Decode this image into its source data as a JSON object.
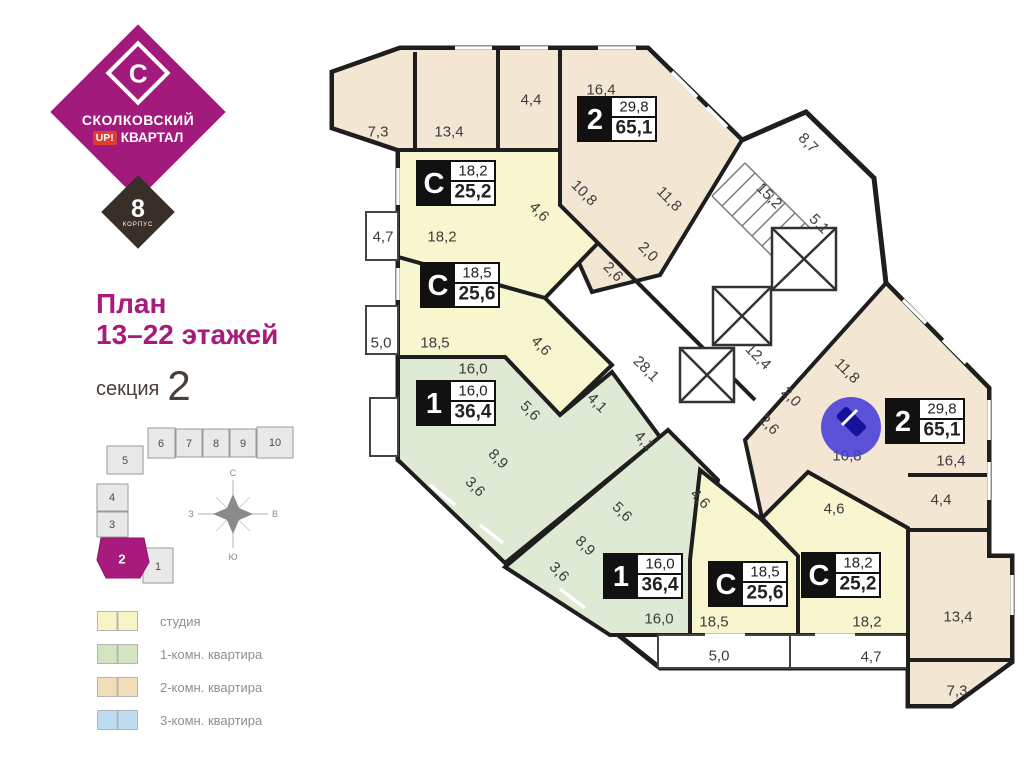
{
  "sidebar": {
    "logo": {
      "letter": "С",
      "brand_top": "СКОЛКОВСКИЙ",
      "up": "UP!",
      "brand_bottom": "КВАРТАЛ",
      "korpus_number": "8",
      "korpus_label": "КОРПУС",
      "purple": "#a21a7c",
      "dark": "#3a2e28",
      "red": "#e23b30"
    },
    "title_line1": "План",
    "title_line2": "13–22 этажей",
    "title_color": "#a81a7b",
    "section_word": "секция",
    "section_number": "2",
    "section_color": "#4a3e37",
    "minimap": {
      "sections": [
        "1",
        "2",
        "3",
        "4",
        "5",
        "6",
        "7",
        "8",
        "9",
        "10"
      ],
      "active_section": "2",
      "active_color": "#a81a7b"
    },
    "compass": {
      "n": "С",
      "s": "Ю",
      "w": "З",
      "e": "В"
    },
    "legend": [
      {
        "label": "студия",
        "color": "#f7f5c5"
      },
      {
        "label": "1-комн. квартира",
        "color": "#d3e5c0"
      },
      {
        "label": "2-комн. квартира",
        "color": "#f1ddb9"
      },
      {
        "label": "3-комн. квартира",
        "color": "#bedcf2"
      }
    ]
  },
  "plan": {
    "fills": {
      "studio": "#f8f6cf",
      "one_room": "#dfead4",
      "two_room": "#f3e7d3",
      "common": "#ffffff"
    },
    "wall_color": "#1e1e1e",
    "badges": [
      {
        "letter": "2",
        "top": "29,8",
        "bottom": "65,1",
        "cx": 617,
        "cy": 119
      },
      {
        "letter": "С",
        "top": "18,2",
        "bottom": "25,2",
        "cx": 456,
        "cy": 183
      },
      {
        "letter": "С",
        "top": "18,5",
        "bottom": "25,6",
        "cx": 460,
        "cy": 285
      },
      {
        "letter": "1",
        "top": "16,0",
        "bottom": "36,4",
        "cx": 456,
        "cy": 403
      },
      {
        "letter": "2",
        "top": "29,8",
        "bottom": "65,1",
        "cx": 925,
        "cy": 421
      },
      {
        "letter": "1",
        "top": "16,0",
        "bottom": "36,4",
        "cx": 643,
        "cy": 576
      },
      {
        "letter": "С",
        "top": "18,5",
        "bottom": "25,6",
        "cx": 748,
        "cy": 584
      },
      {
        "letter": "С",
        "top": "18,2",
        "bottom": "25,2",
        "cx": 841,
        "cy": 575
      }
    ],
    "room_labels": [
      {
        "t": "7,3",
        "x": 378,
        "y": 132,
        "r": 0
      },
      {
        "t": "13,4",
        "x": 449,
        "y": 132,
        "r": 0
      },
      {
        "t": "4,4",
        "x": 531,
        "y": 100,
        "r": 0
      },
      {
        "t": "16,4",
        "x": 601,
        "y": 90,
        "r": 0
      },
      {
        "t": "10,8",
        "x": 584,
        "y": 193,
        "r": 45
      },
      {
        "t": "11,8",
        "x": 669,
        "y": 199,
        "r": 45
      },
      {
        "t": "4,6",
        "x": 539,
        "y": 212,
        "r": 45
      },
      {
        "t": "2,0",
        "x": 648,
        "y": 252,
        "r": 45
      },
      {
        "t": "2,6",
        "x": 613,
        "y": 272,
        "r": 45
      },
      {
        "t": "8,7",
        "x": 808,
        "y": 143,
        "r": 45
      },
      {
        "t": "15,2",
        "x": 769,
        "y": 196,
        "r": 45
      },
      {
        "t": "5,1",
        "x": 819,
        "y": 224,
        "r": 45
      },
      {
        "t": "4,7",
        "x": 383,
        "y": 237,
        "r": 0
      },
      {
        "t": "18,2",
        "x": 442,
        "y": 237,
        "r": 0
      },
      {
        "t": "18,5",
        "x": 435,
        "y": 343,
        "r": 0
      },
      {
        "t": "5,0",
        "x": 381,
        "y": 343,
        "r": 0
      },
      {
        "t": "4,6",
        "x": 541,
        "y": 346,
        "r": 45
      },
      {
        "t": "28,1",
        "x": 646,
        "y": 369,
        "r": 45
      },
      {
        "t": "12,4",
        "x": 758,
        "y": 357,
        "r": 45
      },
      {
        "t": "16,0",
        "x": 473,
        "y": 369,
        "r": 0
      },
      {
        "t": "5,6",
        "x": 530,
        "y": 411,
        "r": 45
      },
      {
        "t": "4,1",
        "x": 597,
        "y": 403,
        "r": 45
      },
      {
        "t": "4,1",
        "x": 644,
        "y": 441,
        "r": 45
      },
      {
        "t": "8,9",
        "x": 498,
        "y": 459,
        "r": 45
      },
      {
        "t": "3,6",
        "x": 475,
        "y": 487,
        "r": 45
      },
      {
        "t": "2,0",
        "x": 791,
        "y": 397,
        "r": 45
      },
      {
        "t": "2,6",
        "x": 769,
        "y": 425,
        "r": 45
      },
      {
        "t": "11,8",
        "x": 847,
        "y": 371,
        "r": 45
      },
      {
        "t": "10,8",
        "x": 847,
        "y": 456,
        "r": 0
      },
      {
        "t": "16,4",
        "x": 951,
        "y": 461,
        "r": 0
      },
      {
        "t": "5,6",
        "x": 622,
        "y": 512,
        "r": 45
      },
      {
        "t": "8,9",
        "x": 585,
        "y": 546,
        "r": 45
      },
      {
        "t": "3,6",
        "x": 559,
        "y": 572,
        "r": 45
      },
      {
        "t": "4,6",
        "x": 700,
        "y": 499,
        "r": 45
      },
      {
        "t": "4,6",
        "x": 834,
        "y": 509,
        "r": 0
      },
      {
        "t": "4,4",
        "x": 941,
        "y": 500,
        "r": 0
      },
      {
        "t": "16,0",
        "x": 659,
        "y": 619,
        "r": 0
      },
      {
        "t": "18,5",
        "x": 714,
        "y": 622,
        "r": 0
      },
      {
        "t": "18,2",
        "x": 867,
        "y": 622,
        "r": 0
      },
      {
        "t": "13,4",
        "x": 958,
        "y": 617,
        "r": 0
      },
      {
        "t": "5,0",
        "x": 719,
        "y": 656,
        "r": 0
      },
      {
        "t": "4,7",
        "x": 871,
        "y": 657,
        "r": 0
      },
      {
        "t": "7,3",
        "x": 957,
        "y": 691,
        "r": 0
      }
    ],
    "cursor": {
      "x": 851,
      "y": 427,
      "r": 30,
      "color": "#453ed8"
    }
  }
}
